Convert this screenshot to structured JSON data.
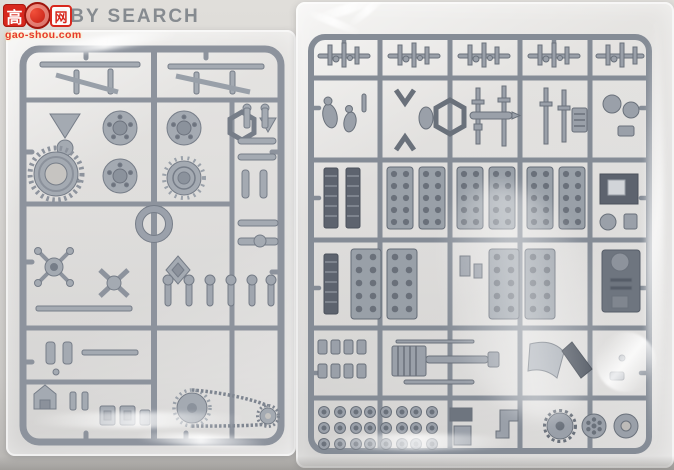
{
  "watermark": {
    "logo_left_char": "高",
    "logo_right_char": "网",
    "brand": "HOBBY SEARCH",
    "url": "gao-shou.com"
  },
  "colors": {
    "background": "#d3d1ce",
    "left_sprue_plastic": "#a4aab2",
    "right_sprue_plastic": "#9aa0a9",
    "logo_red": "#d8281e",
    "brand_grey": "#7f848a",
    "bag_highlight": "#ffffff"
  },
  "scene": {
    "left_bag": "clear-polybag-with-light-grey-model-sprue",
    "right_bag": "clear-polybag-with-grey-detail-model-sprue"
  }
}
